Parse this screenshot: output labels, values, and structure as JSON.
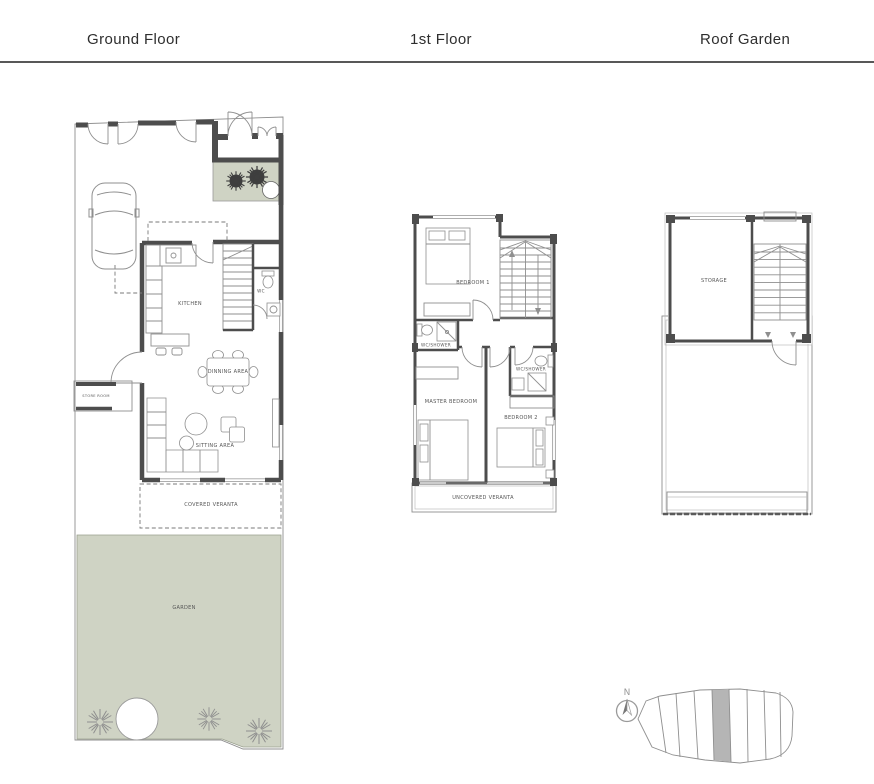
{
  "header": {
    "ground": "Ground Floor",
    "first": "1st Floor",
    "roof": "Roof Garden"
  },
  "ground_floor": {
    "labels": {
      "kitchen": "KITCHEN",
      "wc": "WC",
      "dining": "DINNING AREA",
      "sitting": "SITTING AREA",
      "store_room": "STORE ROOM",
      "covered_veranda": "COVERED VERANTA",
      "garden": "GARDEN"
    }
  },
  "first_floor": {
    "labels": {
      "bedroom1": "BEDROOM 1",
      "wc_shower_a": "WC/SHOWER",
      "master_bedroom": "MASTER BEDROOM",
      "bedroom2": "BEDROOM 2",
      "wc_shower_b": "WC/SHOWER",
      "uncovered_veranda": "UNCOVERED VERANTA"
    }
  },
  "roof_garden": {
    "labels": {
      "storage": "STORAGE"
    }
  },
  "site_plan": {
    "north_label": "N"
  },
  "colors": {
    "garden_green": "#cfd3c4",
    "wall_dark": "#4d4d4d",
    "line_gray": "#8f8f8f",
    "divider": "#585858",
    "site_highlight": "#b5b5b5"
  }
}
